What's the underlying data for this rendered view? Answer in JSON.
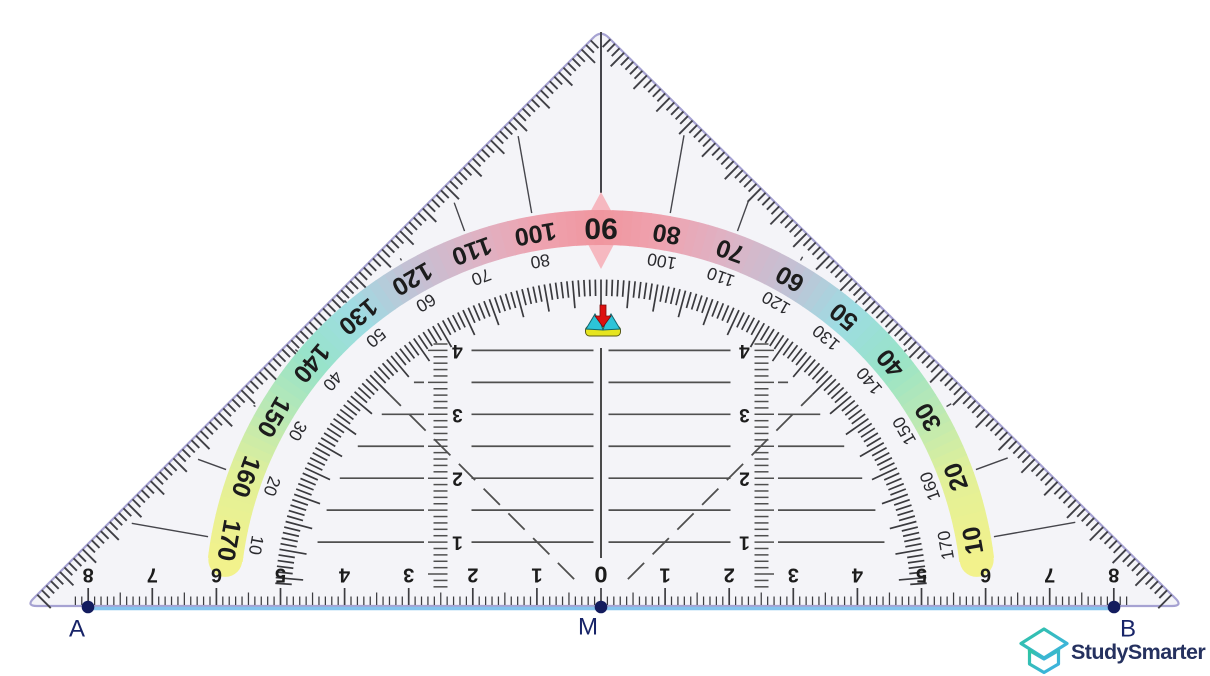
{
  "scene": {
    "width": 1210,
    "height": 676,
    "background": "#ffffff"
  },
  "set_square": {
    "body_fill": "#f4f4f8",
    "edge_color": "#a6a2d2",
    "ink_color": "#45454b",
    "digit_color": "#1c1c1c",
    "apex": {
      "x": 601,
      "y": 30
    },
    "bottom_left": {
      "x": 26,
      "y": 606
    },
    "bottom_right": {
      "x": 1183,
      "y": 606
    },
    "center": {
      "x": 601,
      "y": 606
    }
  },
  "protractor": {
    "degrees": [
      {
        "angle": 10,
        "outer": "10",
        "inner": "170"
      },
      {
        "angle": 20,
        "outer": "20",
        "inner": "160"
      },
      {
        "angle": 30,
        "outer": "30",
        "inner": "150"
      },
      {
        "angle": 40,
        "outer": "40",
        "inner": "140"
      },
      {
        "angle": 50,
        "outer": "50",
        "inner": "130"
      },
      {
        "angle": 60,
        "outer": "60",
        "inner": "120"
      },
      {
        "angle": 70,
        "outer": "70",
        "inner": "110"
      },
      {
        "angle": 80,
        "outer": "80",
        "inner": "100"
      },
      {
        "angle": 90,
        "outer": "90",
        "inner": ""
      },
      {
        "angle": 100,
        "outer": "100",
        "inner": "80"
      },
      {
        "angle": 110,
        "outer": "110",
        "inner": "70"
      },
      {
        "angle": 120,
        "outer": "120",
        "inner": "60"
      },
      {
        "angle": 130,
        "outer": "130",
        "inner": "50"
      },
      {
        "angle": 140,
        "outer": "140",
        "inner": "40"
      },
      {
        "angle": 150,
        "outer": "150",
        "inner": "30"
      },
      {
        "angle": 160,
        "outer": "160",
        "inner": "20"
      },
      {
        "angle": 170,
        "outer": "170",
        "inner": "10"
      }
    ],
    "band_colors": [
      {
        "offset": 0,
        "color": "#f0969e"
      },
      {
        "offset": 10,
        "color": "#eea4b1"
      },
      {
        "offset": 20,
        "color": "#dcb4c6"
      },
      {
        "offset": 30,
        "color": "#c3c1d4"
      },
      {
        "offset": 40,
        "color": "#9edce3"
      },
      {
        "offset": 50,
        "color": "#98e3c8"
      },
      {
        "offset": 60,
        "color": "#bce9b3"
      },
      {
        "offset": 70,
        "color": "#e2f098"
      },
      {
        "offset": 84,
        "color": "#f3f28b"
      }
    ],
    "diamond_color": "#f6b8c0"
  },
  "ruler": {
    "labels": [
      "8",
      "7",
      "6",
      "5",
      "4",
      "3",
      "2",
      "1",
      "0",
      "1",
      "2",
      "3",
      "4",
      "5",
      "6",
      "7",
      "8"
    ],
    "zero_label": "0"
  },
  "parallel_scale": {
    "labels": [
      "4",
      "3",
      "2",
      "1"
    ]
  },
  "construction": {
    "segment_color": "#84c4ee",
    "point_color": "#131c5e",
    "label_color": "#182468",
    "points": {
      "a": {
        "label": "A",
        "x": 88,
        "y": 607
      },
      "m": {
        "label": "M",
        "x": 601,
        "y": 607
      },
      "b": {
        "label": "B",
        "x": 1114,
        "y": 607
      }
    }
  },
  "center_mark": {
    "arrow_color": "#dd1010",
    "mound_color": "#2cc4d8",
    "base_color": "#e6e520"
  },
  "brand": {
    "name": "StudySmarter",
    "text_color": "#25315f",
    "icon_gradient": [
      "#2ec4a2",
      "#41b0e9"
    ]
  }
}
